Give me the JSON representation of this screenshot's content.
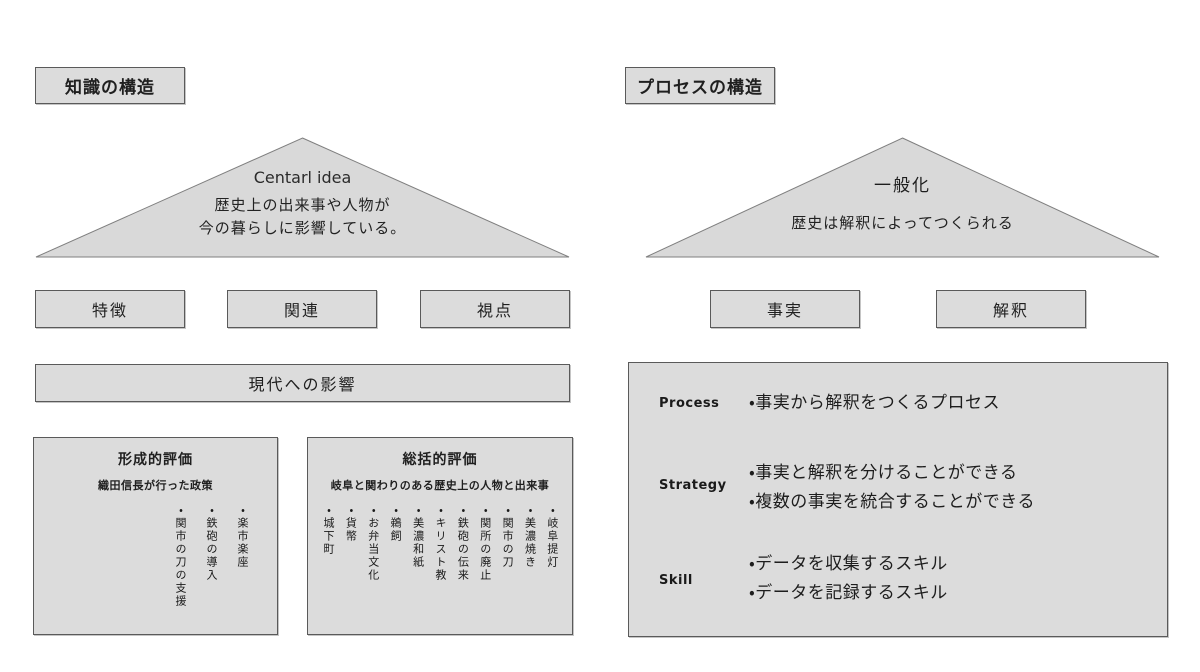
{
  "colors": {
    "box_fill": "#dcdcdc",
    "box_border": "#5a5a5a",
    "triangle_fill": "#d9d9d9",
    "triangle_stroke": "#7f7f7f",
    "background": "#ffffff"
  },
  "left": {
    "title": "知識の構造",
    "triangle": {
      "heading": "Centarl idea",
      "line1": "歴史上の出来事や人物が",
      "line2": "今の暮らしに影響している。"
    },
    "row_boxes": [
      "特徴",
      "関連",
      "視点"
    ],
    "wide_box": "現代への影響",
    "formative": {
      "title": "形成的評価",
      "subtitle": "織田信長が行った政策",
      "items": [
        "・楽市楽座",
        "・鉄砲の導入",
        "・関市の刀の支援"
      ]
    },
    "summative": {
      "title": "総括的評価",
      "subtitle": "岐阜と関わりのある歴史上の人物と出来事",
      "items": [
        "・岐阜提灯",
        "・美濃焼き",
        "・関市の刀",
        "・関所の廃止",
        "・鉄砲の伝来",
        "・キリスト教",
        "・美濃和紙",
        "・鵜飼",
        "・お弁当文化",
        "・貨幣",
        "・城下町"
      ]
    }
  },
  "right": {
    "title": "プロセスの構造",
    "triangle": {
      "heading": "一般化",
      "line1": "歴史は解釈によってつくられる"
    },
    "row_boxes": [
      "事実",
      "解釈"
    ],
    "detail": {
      "rows": [
        {
          "label": "Process",
          "bullet1": "・事実から解釈をつくるプロセス",
          "bullet2": ""
        },
        {
          "label": "Strategy",
          "bullet1": "・事実と解釈を分けることができる",
          "bullet2": "・複数の事実を統合することができる"
        },
        {
          "label": "Skill",
          "bullet1": "・データを収集するスキル",
          "bullet2": "・データを記録するスキル"
        }
      ]
    }
  }
}
